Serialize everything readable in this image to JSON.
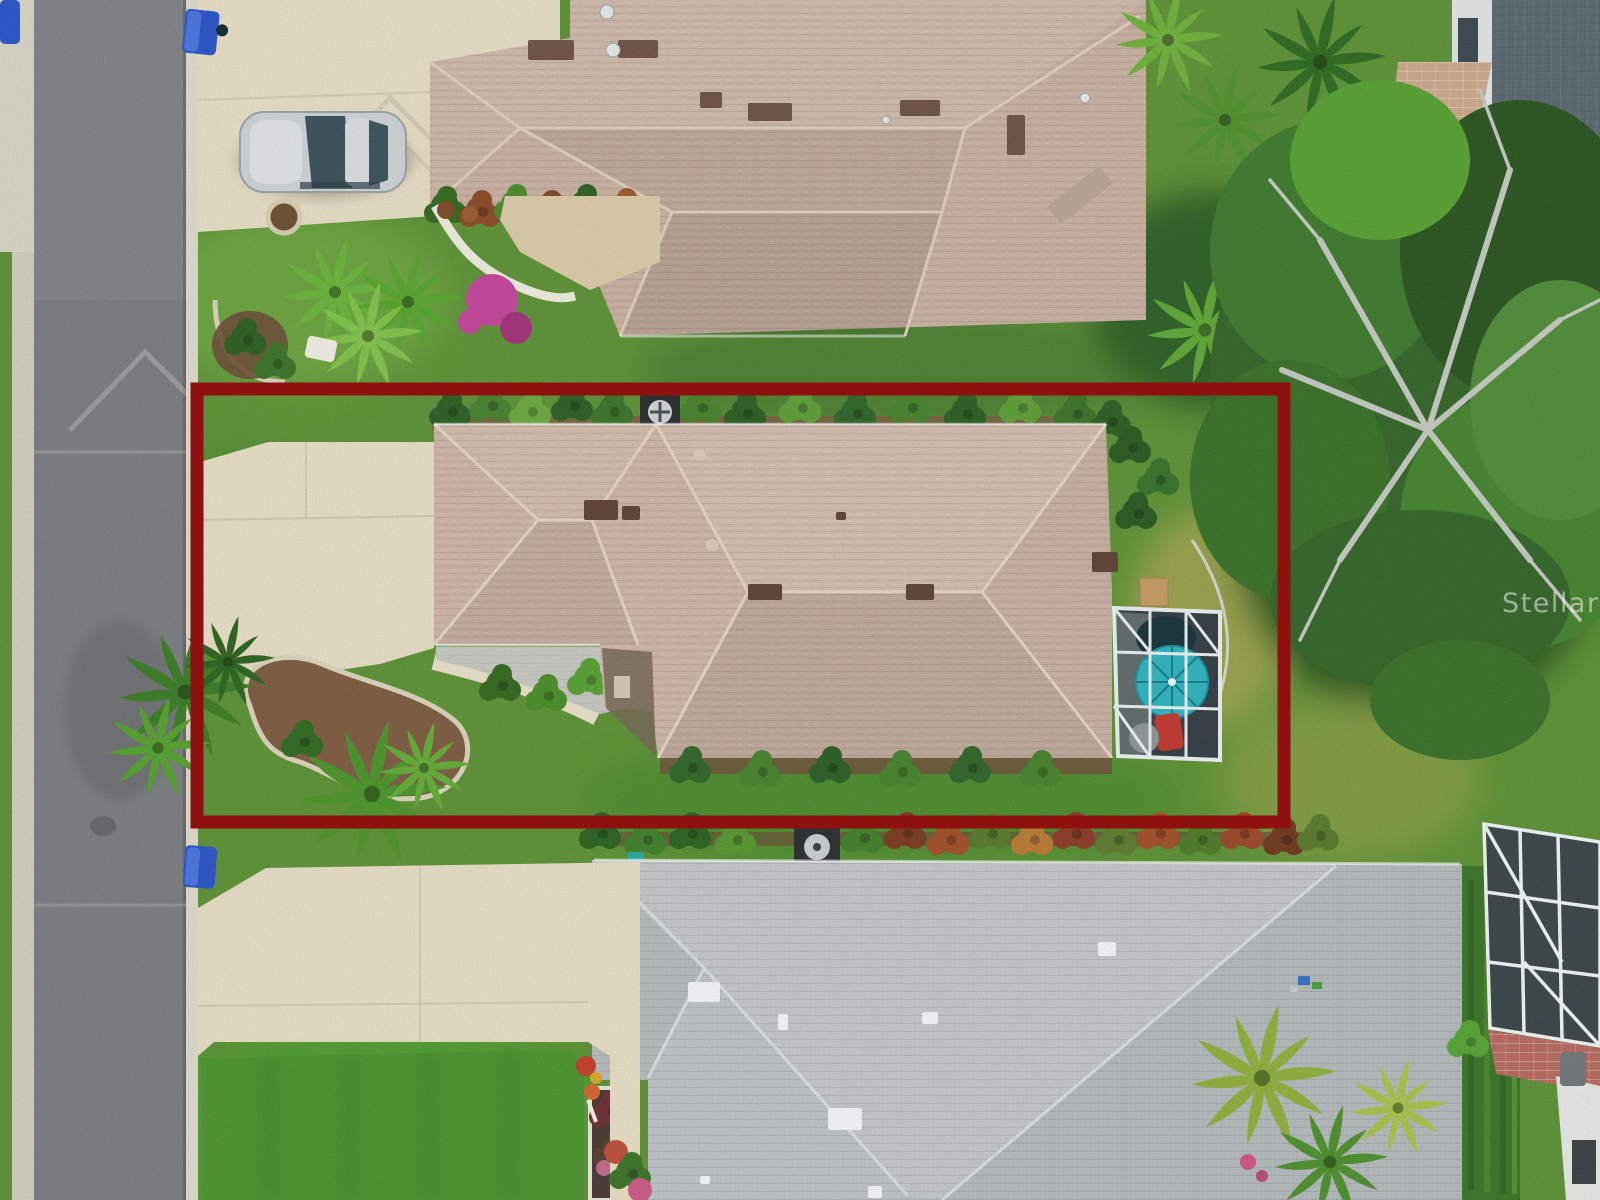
{
  "watermark": {
    "text": "Stellar MLS"
  },
  "overlay": {
    "type": "property-boundary-rectangle"
  },
  "colors": {
    "boundary_red": "#8e1110",
    "umbrella_teal": "#2fb3be",
    "bin_blue": "#2b55c6",
    "road_asphalt": "#7a7d80",
    "curb_concrete": "#dcd8cb",
    "driveway_concrete": "#e5dcc3",
    "subject_roof_tan": "#ccb4a5",
    "neighbor_roof_tan": "#c7afa0",
    "bottom_roof_gray": "#bcc1c3",
    "grass_green": "#5d9136",
    "pool_cage_screen": "#333e44",
    "chair_red": "#c0392f",
    "flower_magenta": "#c2469a",
    "car_silver": "#ccd1d4"
  },
  "scene": {
    "type": "aerial-drone-photo",
    "objects": [
      "street",
      "sidewalk",
      "curbs",
      "recycling-bins",
      "silver-car",
      "neighbor-house-top",
      "subject-house",
      "property-boundary-overlay",
      "pool-enclosure",
      "patio-umbrella",
      "spa",
      "red-chair",
      "neighbor-house-bottom",
      "oak-tree",
      "palm-trees",
      "mulch-beds",
      "gravel-bed",
      "driveways",
      "lawns",
      "hedges",
      "ac-units",
      "right-house-lanai",
      "watermark"
    ]
  }
}
